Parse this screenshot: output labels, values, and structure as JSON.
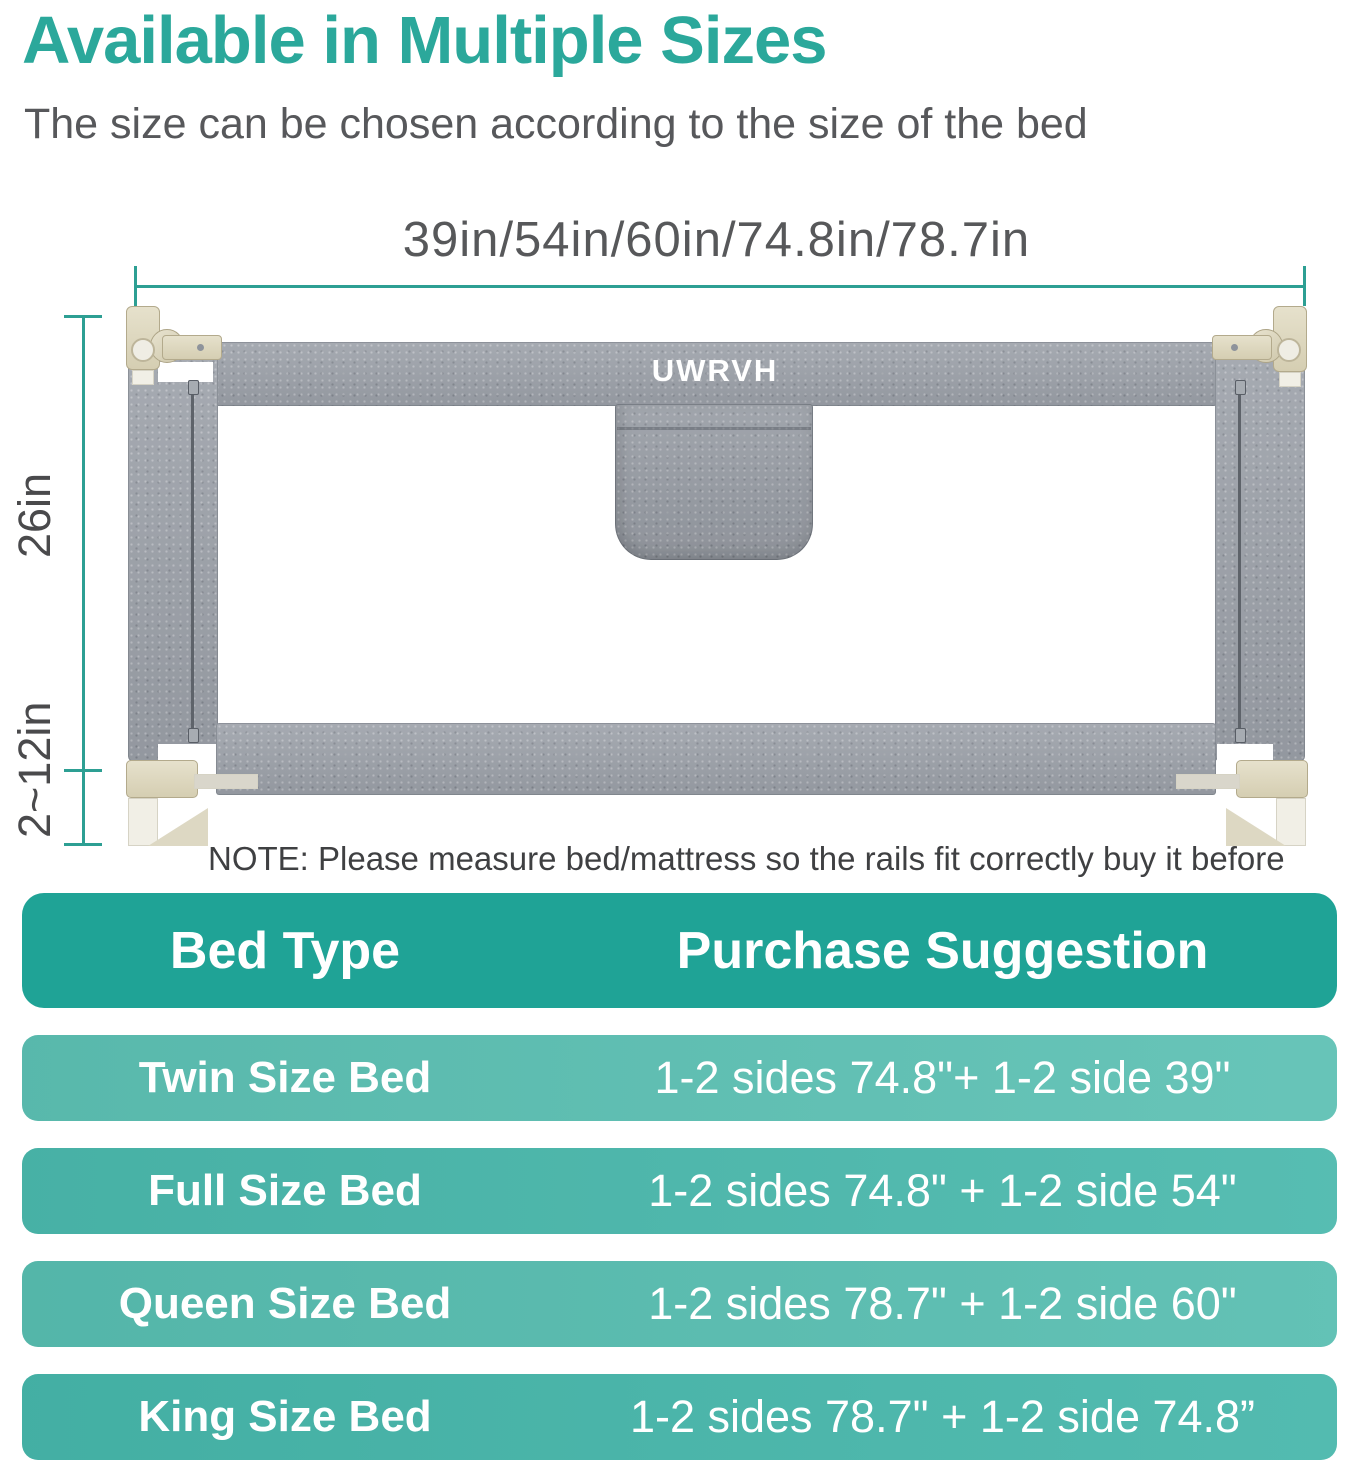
{
  "header": {
    "title": "Available in Multiple Sizes",
    "subtitle": "The size can be chosen according to the size of the bed"
  },
  "diagram": {
    "width_dimension_label": "39in/54in/60in/74.8in/78.7in",
    "height_dimension_label": "26in",
    "bottom_gap_dimension_label": "2~12in",
    "brand_logo": "UWRVH",
    "note": "NOTE: Please measure bed/mattress so the rails fit correctly buy it before"
  },
  "size_table": {
    "columns": [
      "Bed Type",
      "Purchase Suggestion"
    ],
    "rows": [
      {
        "bed_type": "Twin Size Bed",
        "suggestion": "1-2 sides 74.8\"+ 1-2 side 39\""
      },
      {
        "bed_type": "Full Size Bed",
        "suggestion": "1-2 sides 74.8\" + 1-2 side 54\""
      },
      {
        "bed_type": "Queen Size Bed",
        "suggestion": "1-2 sides 78.7\" + 1-2 side 60\""
      },
      {
        "bed_type": "King Size Bed",
        "suggestion": "1-2 sides 78.7\" + 1-2 side 74.8”"
      }
    ]
  },
  "colors": {
    "accent_teal": "#2BA89B",
    "dimension_line_teal": "#2D9F93",
    "table_header_teal": "#1FA396",
    "table_row_light": "#5CC0B3",
    "table_row_dark": "#46B6AA",
    "fabric_gray": "#9CA1A9",
    "hardware_cream": "#DED8C2"
  }
}
